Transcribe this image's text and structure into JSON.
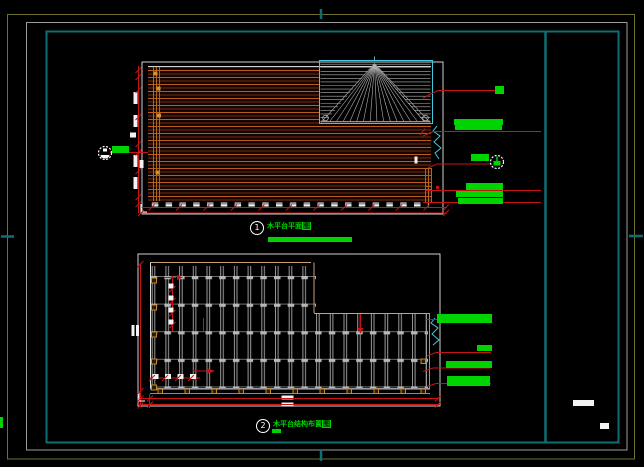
{
  "sheet": {
    "background": "#000000",
    "frame": {
      "outer_color": "#6f6f2e",
      "middle_color": "#9c9c9c",
      "inner_color": "#0d6f73"
    },
    "title_strip": {
      "present": true,
      "divider_x_ratio": 0.85
    }
  },
  "plans": [
    {
      "bubble": "1",
      "title_main": "木平台平面",
      "title_highlight": "图"
    },
    {
      "bubble": "2",
      "title_main": "木平台结构布置",
      "title_highlight": "图"
    }
  ],
  "colors": {
    "annotation_green": "#00d400",
    "dimension_red": "#c81414",
    "deck_orange": "#b85c1c",
    "break_line_cyan": "#46c8dc",
    "grid_gray": "#9a9a9a",
    "wood_marker_orange": "#c98a1e",
    "hip_hatch_gray": "#b4b4b4"
  }
}
